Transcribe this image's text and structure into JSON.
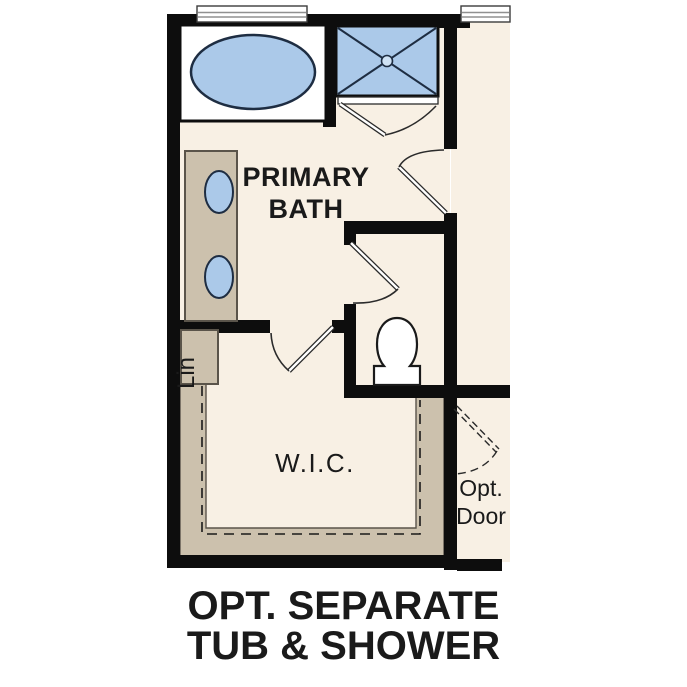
{
  "labels": {
    "primary_bath": {
      "line1": "PRIMARY",
      "line2": "BATH"
    },
    "linen_closet": "Lin",
    "walk_in_closet": "W.I.C.",
    "optional_door": {
      "line1": "Opt.",
      "line2": "Door"
    }
  },
  "caption": {
    "line1": "OPT. SEPARATE",
    "line2": "TUB & SHOWER"
  },
  "colors": {
    "floor": "#f8f0e4",
    "cabinetry": "#ccc1ad",
    "cabinetry_outline": "#5a544a",
    "fixture_blue": "#abc9e9",
    "drain_blue": "#cfe2f4",
    "wall_black": "#0d0d0d",
    "fixture_outline": "#1e2d42",
    "line_dark": "#2b2b2b",
    "window_gray": "#909090"
  },
  "fixtures": [
    "garden-tub",
    "walk-in-shower",
    "double-sink-vanity",
    "toilet",
    "linen-closet",
    "closet-shelving"
  ]
}
